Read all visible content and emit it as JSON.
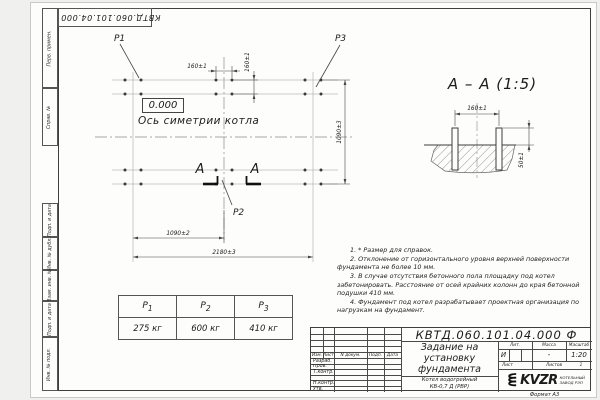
{
  "page": {
    "format_label": "Формат А3"
  },
  "stamps": {
    "top_designation": "КВТД.060.101.04.000 Ф",
    "left_column": [
      "Перв. примен.",
      "Справ. №",
      "Подп. и дата",
      "Инв. № дубл.",
      "Взам. инв. №",
      "Подп. и дата",
      "Инв. № подл."
    ]
  },
  "plan": {
    "p1": "P1",
    "p2": "P2",
    "p3": "P3",
    "level_mark": "0.000",
    "axis_label": "Ось симетрии котла",
    "section_letter_left": "A",
    "section_letter_right": "A",
    "dim_160_h": "160±1",
    "dim_160_v": "160±1",
    "dim_1090_v": "1090±3",
    "dim_1090_h": "1090±2",
    "dim_2180": "2180±3"
  },
  "section": {
    "title": "A – A (1:5)",
    "dim_160": "160±1",
    "dim_50": "50±1"
  },
  "notes": {
    "items": [
      "1. * Размер для справок.",
      "2. Отклонение от горизонтального уровня верхней поверхности фундамента не более 10 мм.",
      "3. В случае отсутствия бетонного пола площадку под котел забетонировать. Расстояние от осей крайних колонн до края бетонной подушки 410 мм.",
      "4. Фундамент под котел разрабатывает проектная организация по нагрузкам на фундамент."
    ]
  },
  "load_table": {
    "headers": [
      {
        "base": "P",
        "sub": "1"
      },
      {
        "base": "P",
        "sub": "2"
      },
      {
        "base": "P",
        "sub": "3"
      }
    ],
    "values": [
      "275 кг",
      "600 кг",
      "410 кг"
    ]
  },
  "title_block": {
    "designation": "КВТД.060.101.04.000  Ф",
    "doc_title": "Задание на установку фундамента",
    "product_line1": "Котел водогрейный",
    "product_line2": "КВ-0,7 Д (РВР)",
    "change_headers": [
      "Изм.",
      "Лист",
      "N докум.",
      "Подп.",
      "Дата"
    ],
    "sign_rows": [
      "Разраб.",
      "Пров.",
      "Т.контр.",
      "Н.контр.",
      "Утв."
    ],
    "lit_label": "Лит.",
    "mass_label": "Масса",
    "scale_label": "Масштаб",
    "lit_value": "И",
    "mass_value": "-",
    "scale_value": "1:20",
    "sheet_label": "Лист",
    "sheets_label": "Листов",
    "sheets_value": "1",
    "brand": "KVZR",
    "brand_line1": "КОТЕЛЬНЫЙ",
    "brand_line2": "ЗАВОД РЭП"
  }
}
